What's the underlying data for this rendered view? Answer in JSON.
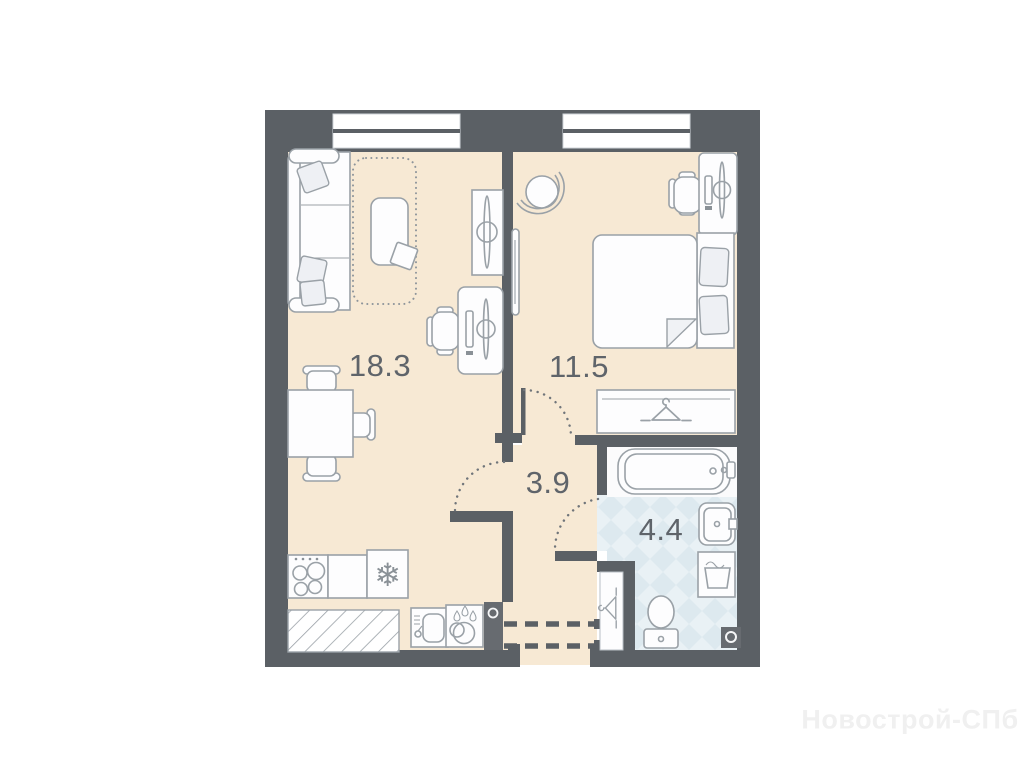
{
  "plan": {
    "rooms": [
      {
        "name": "living-room-kitchen",
        "area_label": "18.3"
      },
      {
        "name": "bedroom",
        "area_label": "11.5"
      },
      {
        "name": "hallway",
        "area_label": "3.9"
      },
      {
        "name": "bathroom",
        "area_label": "4.4"
      }
    ],
    "watermark": "Новострой-СПб",
    "icons": {
      "fridge_snowflake": "❄"
    },
    "colors": {
      "wall": "#5b6065",
      "floor": "#f7e9d4",
      "tile-base": "#e9f1f5",
      "tile-diamond": "#dde9ef",
      "line": "#9aa1a7",
      "white": "#fdfdfe",
      "label": "#5f646a",
      "watermark": "#f0f0f0",
      "shaft": "#676b70",
      "arc": "#70757a"
    }
  }
}
